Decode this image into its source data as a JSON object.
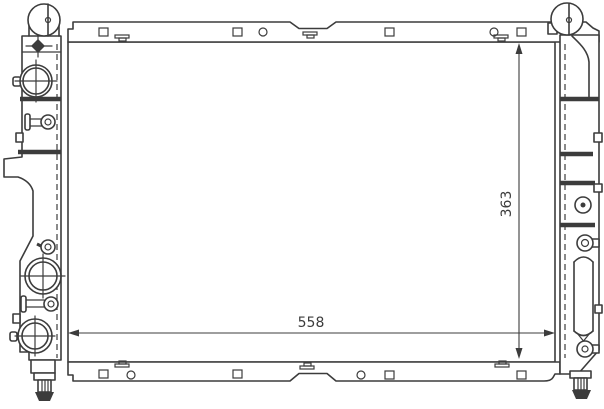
{
  "drawing": {
    "labels": {
      "width": "558",
      "height": "363"
    },
    "colors": {
      "line": "#3c3c3c",
      "background": "#ffffff"
    }
  }
}
